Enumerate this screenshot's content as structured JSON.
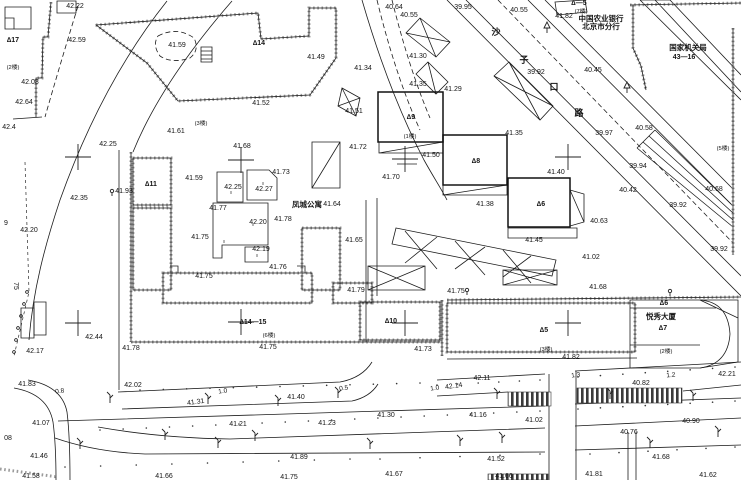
{
  "map": {
    "kind": "cadastral-survey-plan",
    "labels": {
      "elevations": [
        {
          "t": "42.22",
          "x": 75,
          "y": 8
        },
        {
          "t": "42.59",
          "x": 77,
          "y": 42
        },
        {
          "t": "41.59",
          "x": 177,
          "y": 47
        },
        {
          "t": "42.08",
          "x": 30,
          "y": 84
        },
        {
          "t": "42.64",
          "x": 24,
          "y": 104
        },
        {
          "t": "42.4",
          "x": 9,
          "y": 129
        },
        {
          "t": "42.25",
          "x": 108,
          "y": 146
        },
        {
          "t": "41.61",
          "x": 176,
          "y": 133
        },
        {
          "t": "42.35",
          "x": 79,
          "y": 200
        },
        {
          "t": "42.20",
          "x": 29,
          "y": 232
        },
        {
          "t": "42.17",
          "x": 35,
          "y": 353
        },
        {
          "t": "42.44",
          "x": 94,
          "y": 339
        },
        {
          "t": "41.78",
          "x": 131,
          "y": 350
        },
        {
          "t": "41.83",
          "x": 27,
          "y": 386
        },
        {
          "t": "42.02",
          "x": 133,
          "y": 387
        },
        {
          "t": "41.31",
          "x": 196,
          "y": 404,
          "r": -8
        },
        {
          "t": "41.07",
          "x": 41,
          "y": 425
        },
        {
          "t": "41.21",
          "x": 238,
          "y": 426
        },
        {
          "t": "41.23",
          "x": 327,
          "y": 425
        },
        {
          "t": "41.46",
          "x": 39,
          "y": 458
        },
        {
          "t": "41.58",
          "x": 31,
          "y": 478
        },
        {
          "t": "41.66",
          "x": 164,
          "y": 478
        },
        {
          "t": "41.89",
          "x": 299,
          "y": 459
        },
        {
          "t": "41.75",
          "x": 289,
          "y": 479
        },
        {
          "t": "41.40",
          "x": 296,
          "y": 399
        },
        {
          "t": "41.30",
          "x": 386,
          "y": 417
        },
        {
          "t": "41.16",
          "x": 478,
          "y": 417
        },
        {
          "t": "41.02",
          "x": 534,
          "y": 422
        },
        {
          "t": "41.67",
          "x": 394,
          "y": 476
        },
        {
          "t": "41.66",
          "x": 504,
          "y": 478
        },
        {
          "t": "41.52",
          "x": 496,
          "y": 461
        },
        {
          "t": "41.68",
          "x": 661,
          "y": 459
        },
        {
          "t": "41.81",
          "x": 594,
          "y": 476
        },
        {
          "t": "41.62",
          "x": 708,
          "y": 477
        },
        {
          "t": "40.82",
          "x": 641,
          "y": 385
        },
        {
          "t": "40.76",
          "x": 629,
          "y": 434
        },
        {
          "t": "40.90",
          "x": 691,
          "y": 423
        },
        {
          "t": "42.14",
          "x": 454,
          "y": 388,
          "r": -8
        },
        {
          "t": "42.11",
          "x": 482,
          "y": 380
        },
        {
          "t": "41.93",
          "x": 124,
          "y": 193
        },
        {
          "t": "41.59",
          "x": 194,
          "y": 180
        },
        {
          "t": "41.68",
          "x": 242,
          "y": 148
        },
        {
          "t": "41.73",
          "x": 281,
          "y": 174
        },
        {
          "t": "42.25",
          "x": 233,
          "y": 189
        },
        {
          "t": "42.27",
          "x": 264,
          "y": 191
        },
        {
          "t": "41.77",
          "x": 218,
          "y": 210
        },
        {
          "t": "42.20",
          "x": 258,
          "y": 224
        },
        {
          "t": "41.78",
          "x": 283,
          "y": 221
        },
        {
          "t": "41.75",
          "x": 200,
          "y": 239
        },
        {
          "t": "42.19",
          "x": 261,
          "y": 251
        },
        {
          "t": "41.76",
          "x": 278,
          "y": 269
        },
        {
          "t": "41.75",
          "x": 204,
          "y": 278
        },
        {
          "t": "41.64",
          "x": 332,
          "y": 206
        },
        {
          "t": "41.65",
          "x": 354,
          "y": 242
        },
        {
          "t": "41.49",
          "x": 316,
          "y": 59
        },
        {
          "t": "41.52",
          "x": 261,
          "y": 105
        },
        {
          "t": "41.51",
          "x": 354,
          "y": 113
        },
        {
          "t": "41.72",
          "x": 358,
          "y": 149
        },
        {
          "t": "41.50",
          "x": 431,
          "y": 157
        },
        {
          "t": "41.70",
          "x": 391,
          "y": 179
        },
        {
          "t": "41.75",
          "x": 268,
          "y": 349
        },
        {
          "t": "41.79",
          "x": 356,
          "y": 292
        },
        {
          "t": "41.75",
          "x": 456,
          "y": 293
        },
        {
          "t": "41.68",
          "x": 598,
          "y": 289
        },
        {
          "t": "41.73",
          "x": 423,
          "y": 351
        },
        {
          "t": "41.82",
          "x": 571,
          "y": 359
        },
        {
          "t": "41.35",
          "x": 418,
          "y": 86
        },
        {
          "t": "41.29",
          "x": 453,
          "y": 91
        },
        {
          "t": "41.30",
          "x": 418,
          "y": 58
        },
        {
          "t": "41.34",
          "x": 363,
          "y": 70
        },
        {
          "t": "40.64",
          "x": 394,
          "y": 9
        },
        {
          "t": "40.55",
          "x": 409,
          "y": 17
        },
        {
          "t": "39.95",
          "x": 463,
          "y": 9
        },
        {
          "t": "40.55",
          "x": 519,
          "y": 12
        },
        {
          "t": "41.82",
          "x": 564,
          "y": 18
        },
        {
          "t": "39.92",
          "x": 536,
          "y": 74
        },
        {
          "t": "40.45",
          "x": 593,
          "y": 72
        },
        {
          "t": "40.58",
          "x": 644,
          "y": 130
        },
        {
          "t": "39.97",
          "x": 604,
          "y": 135
        },
        {
          "t": "41.35",
          "x": 514,
          "y": 135
        },
        {
          "t": "40.68",
          "x": 714,
          "y": 191
        },
        {
          "t": "39.94",
          "x": 638,
          "y": 168
        },
        {
          "t": "40.42",
          "x": 628,
          "y": 192
        },
        {
          "t": "39.92",
          "x": 678,
          "y": 207
        },
        {
          "t": "39.92",
          "x": 719,
          "y": 251
        },
        {
          "t": "41.40",
          "x": 556,
          "y": 174
        },
        {
          "t": "41.38",
          "x": 485,
          "y": 206
        },
        {
          "t": "40.63",
          "x": 599,
          "y": 223
        },
        {
          "t": "41.45",
          "x": 534,
          "y": 242
        },
        {
          "t": "41.02",
          "x": 591,
          "y": 259
        },
        {
          "t": "42.21",
          "x": 727,
          "y": 376
        }
      ],
      "building_ids": [
        {
          "t": "∆17",
          "x": 13,
          "y": 42
        },
        {
          "t": "∆14",
          "x": 259,
          "y": 45
        },
        {
          "t": "∆11",
          "x": 151,
          "y": 186
        },
        {
          "t": "∆9",
          "x": 411,
          "y": 119
        },
        {
          "t": "∆8",
          "x": 476,
          "y": 163
        },
        {
          "t": "∆6",
          "x": 541,
          "y": 206
        },
        {
          "t": "∆10",
          "x": 391,
          "y": 323
        },
        {
          "t": "∆14—15",
          "x": 253,
          "y": 324
        },
        {
          "t": "∆5",
          "x": 544,
          "y": 332
        },
        {
          "t": "∆6",
          "x": 664,
          "y": 305
        },
        {
          "t": "∆7",
          "x": 663,
          "y": 330
        },
        {
          "t": "∆—5",
          "x": 579,
          "y": 5
        },
        {
          "t": "43—16",
          "x": 684,
          "y": 59
        }
      ],
      "floors": [
        {
          "t": "(3楼)",
          "x": 201,
          "y": 125
        },
        {
          "t": "(2楼)",
          "x": 13,
          "y": 69
        },
        {
          "t": "(7楼)",
          "x": 581,
          "y": 13
        },
        {
          "t": "(1楼)",
          "x": 410,
          "y": 138
        },
        {
          "t": "(6楼)",
          "x": 269,
          "y": 337
        },
        {
          "t": "(3楼)",
          "x": 546,
          "y": 351
        },
        {
          "t": "(2楼)",
          "x": 666,
          "y": 353
        },
        {
          "t": "(5楼)",
          "x": 723,
          "y": 150
        }
      ],
      "places": [
        {
          "t": "凤城公寓",
          "x": 307,
          "y": 207
        },
        {
          "t": "悦秀大厦",
          "x": 661,
          "y": 319
        },
        {
          "t": "国家机关局",
          "x": 688,
          "y": 50,
          "s": 6.2
        },
        {
          "t": "中国农业银行",
          "x": 601,
          "y": 21,
          "s": 5.5
        },
        {
          "t": "北京市分行",
          "x": 601,
          "y": 29,
          "s": 5.5
        }
      ],
      "road_name": [
        {
          "t": "沙",
          "x": 496,
          "y": 35
        },
        {
          "t": "子",
          "x": 524,
          "y": 63
        },
        {
          "t": "口",
          "x": 554,
          "y": 90
        },
        {
          "t": "路",
          "x": 579,
          "y": 116
        }
      ],
      "road_widths": [
        {
          "t": "0.8",
          "x": 60,
          "y": 393,
          "r": -8
        },
        {
          "t": "1.0",
          "x": 223,
          "y": 393,
          "r": -8
        },
        {
          "t": "0.5",
          "x": 344,
          "y": 390,
          "r": -8
        },
        {
          "t": "1.0",
          "x": 435,
          "y": 390,
          "r": -8
        },
        {
          "t": "1.3",
          "x": 576,
          "y": 377,
          "r": -8
        },
        {
          "t": "1.2",
          "x": 671,
          "y": 377,
          "r": -5
        }
      ],
      "storeys": [
        {
          "t": "II",
          "x": 231,
          "y": 194
        },
        {
          "t": "II",
          "x": 263,
          "y": 185
        },
        {
          "t": "II",
          "x": 253,
          "y": 226
        },
        {
          "t": "II",
          "x": 224,
          "y": 243
        },
        {
          "t": "II",
          "x": 257,
          "y": 257
        }
      ],
      "misc": [
        {
          "t": "75",
          "x": 14,
          "y": 286,
          "r": 90
        },
        {
          "t": "08",
          "x": 8,
          "y": 440
        },
        {
          "t": "9",
          "x": 6,
          "y": 225
        }
      ]
    },
    "symbols": {
      "grid_crosses": [
        [
          78,
          157
        ],
        [
          241,
          160
        ],
        [
          405,
          159
        ],
        [
          568,
          157
        ],
        [
          78,
          323
        ],
        [
          241,
          322
        ],
        [
          405,
          323
        ],
        [
          568,
          323
        ]
      ],
      "poles": [
        [
          110,
          403
        ],
        [
          208,
          404
        ],
        [
          278,
          406
        ],
        [
          338,
          398
        ],
        [
          497,
          399
        ],
        [
          693,
          401
        ],
        [
          370,
          449
        ],
        [
          460,
          446
        ],
        [
          80,
          449
        ],
        [
          218,
          448
        ],
        [
          502,
          443
        ],
        [
          650,
          448
        ],
        [
          718,
          437
        ],
        [
          165,
          440
        ],
        [
          255,
          441
        ],
        [
          610,
          399
        ]
      ],
      "trees": [
        [
          547,
          33
        ],
        [
          627,
          93
        ]
      ],
      "benchmarks": [
        [
          112,
          191
        ],
        [
          467,
          290
        ],
        [
          670,
          291
        ]
      ],
      "fence_circles": [
        [
          27,
          292
        ],
        [
          24,
          304
        ],
        [
          21,
          316
        ],
        [
          18,
          328
        ],
        [
          16,
          340
        ],
        [
          14,
          352
        ]
      ]
    },
    "line_color": "#1c1c1c",
    "wall_color": "#9b9b9b"
  }
}
